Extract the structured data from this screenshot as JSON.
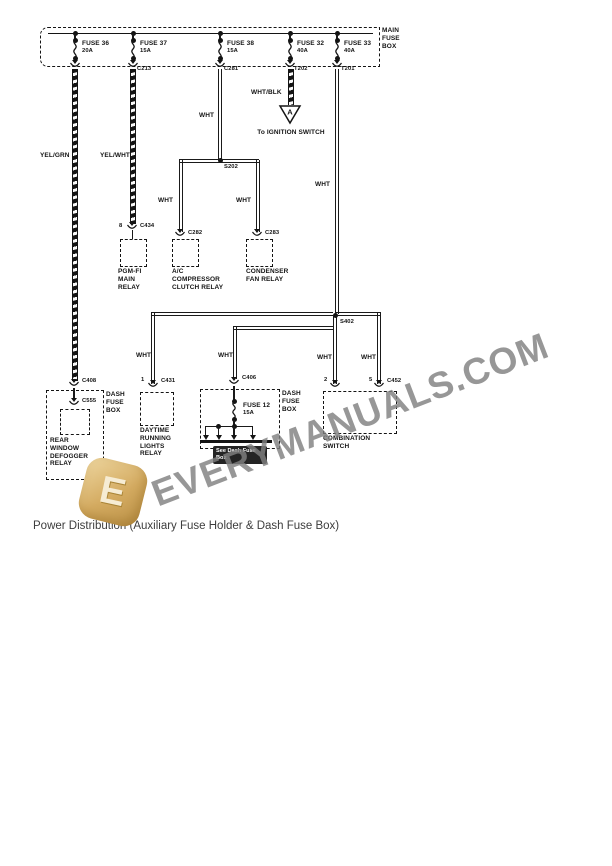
{
  "page": {
    "caption": "Power Distribution (Auxiliary Fuse Holder & Dash Fuse Box)"
  },
  "watermark": {
    "text": "EVERYMANUALS.COM",
    "logo_letter": "E"
  },
  "main_fuse_box": {
    "label": "MAIN FUSE BOX",
    "fuses": [
      {
        "name": "FUSE 36",
        "amps": "20A",
        "connector": ""
      },
      {
        "name": "FUSE 37",
        "amps": "15A",
        "connector": "C213"
      },
      {
        "name": "FUSE 38",
        "amps": "15A",
        "connector": "C281"
      },
      {
        "name": "FUSE 32",
        "amps": "40A",
        "connector": "T202"
      },
      {
        "name": "FUSE 33",
        "amps": "40A",
        "connector": "T201"
      }
    ]
  },
  "wires": {
    "yel_grn": "YEL/GRN",
    "yel_wht": "YEL/WHT",
    "wht": "WHT",
    "wht_blk": "WHT/BLK"
  },
  "splices": {
    "s202": "S202",
    "s402": "S402"
  },
  "ignition": {
    "arrow_letter": "A",
    "label": "To IGNITION SWITCH"
  },
  "relays": {
    "pgm_fi": {
      "pin": "8",
      "connector": "C434",
      "label": "PGM-FI MAIN RELAY"
    },
    "ac_compressor": {
      "connector": "C282",
      "label": "A/C COMPRESSOR CLUTCH RELAY"
    },
    "condenser_fan": {
      "connector": "C283",
      "label": "CONDENSER FAN RELAY"
    }
  },
  "dash_fuse_box_left": {
    "connector": "C408",
    "label": "DASH FUSE BOX",
    "inner_connector": "C555",
    "relay_label": "REAR WINDOW DEFOGGER RELAY"
  },
  "drl_relay": {
    "pin": "1",
    "connector": "C431",
    "label": "DAYTIME RUNNING LIGHTS RELAY"
  },
  "dash_fuse_box_mid": {
    "connector": "C406",
    "label": "DASH FUSE BOX",
    "fuse_name": "FUSE 12",
    "fuse_amps": "15A",
    "ref_label": "See Dash Fuse Box"
  },
  "combination_switch": {
    "pin_left": "2",
    "pin_right": "5",
    "connector": "C452",
    "label": "COMBINATION SWITCH"
  }
}
